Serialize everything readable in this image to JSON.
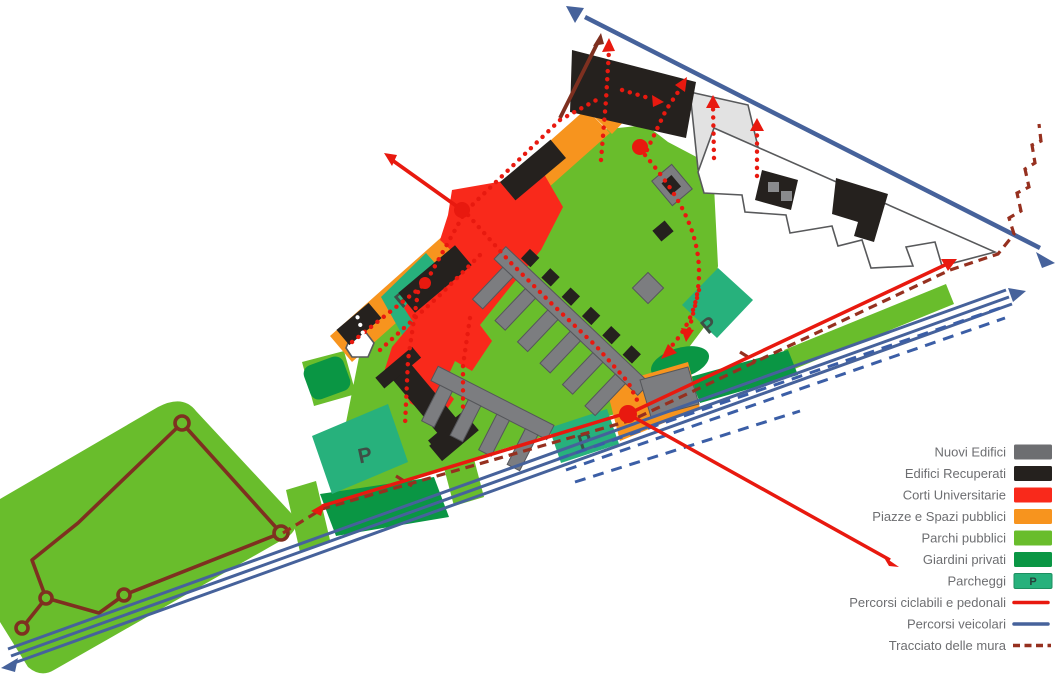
{
  "legend": {
    "items": [
      {
        "label": "Nuovi Edifici",
        "kind": "swatch",
        "color": "#6d6e71"
      },
      {
        "label": "Edifici Recuperati",
        "kind": "swatch",
        "color": "#25211e"
      },
      {
        "label": "Corti Universitarie",
        "kind": "swatch",
        "color": "#f9291b"
      },
      {
        "label": "Piazze e Spazi pubblici",
        "kind": "swatch",
        "color": "#f7941e"
      },
      {
        "label": "Parchi pubblici",
        "kind": "swatch",
        "color": "#69bd2c"
      },
      {
        "label": "Giardini privati",
        "kind": "swatch",
        "color": "#0a9644"
      },
      {
        "label": "Parcheggi",
        "kind": "swatch-p",
        "color": "#27b17c",
        "badge": "P"
      },
      {
        "label": "Percorsi ciclabili e pedonali",
        "kind": "line",
        "color": "#e8190f"
      },
      {
        "label": "Percorsi veicolari",
        "kind": "line",
        "color": "#46629b"
      },
      {
        "label": "Tracciato delle mura",
        "kind": "dashed-line",
        "color": "#96301f"
      }
    ]
  },
  "map": {
    "parking_labels": [
      "P",
      "P",
      "P",
      "P"
    ],
    "colors": {
      "parchi": "#69bd2c",
      "giardini": "#0a9644",
      "parcheggi": "#27b17c",
      "piazze": "#f7941e",
      "corti": "#f9291b",
      "nuovi": "#7c7d80",
      "recuperati": "#25211e",
      "ciclabili": "#e8190f",
      "veicolari": "#46629b",
      "veicolari_dash": "#3b5ea6",
      "tracciato": "#96301f",
      "mura_parco": "#7e3020"
    }
  }
}
